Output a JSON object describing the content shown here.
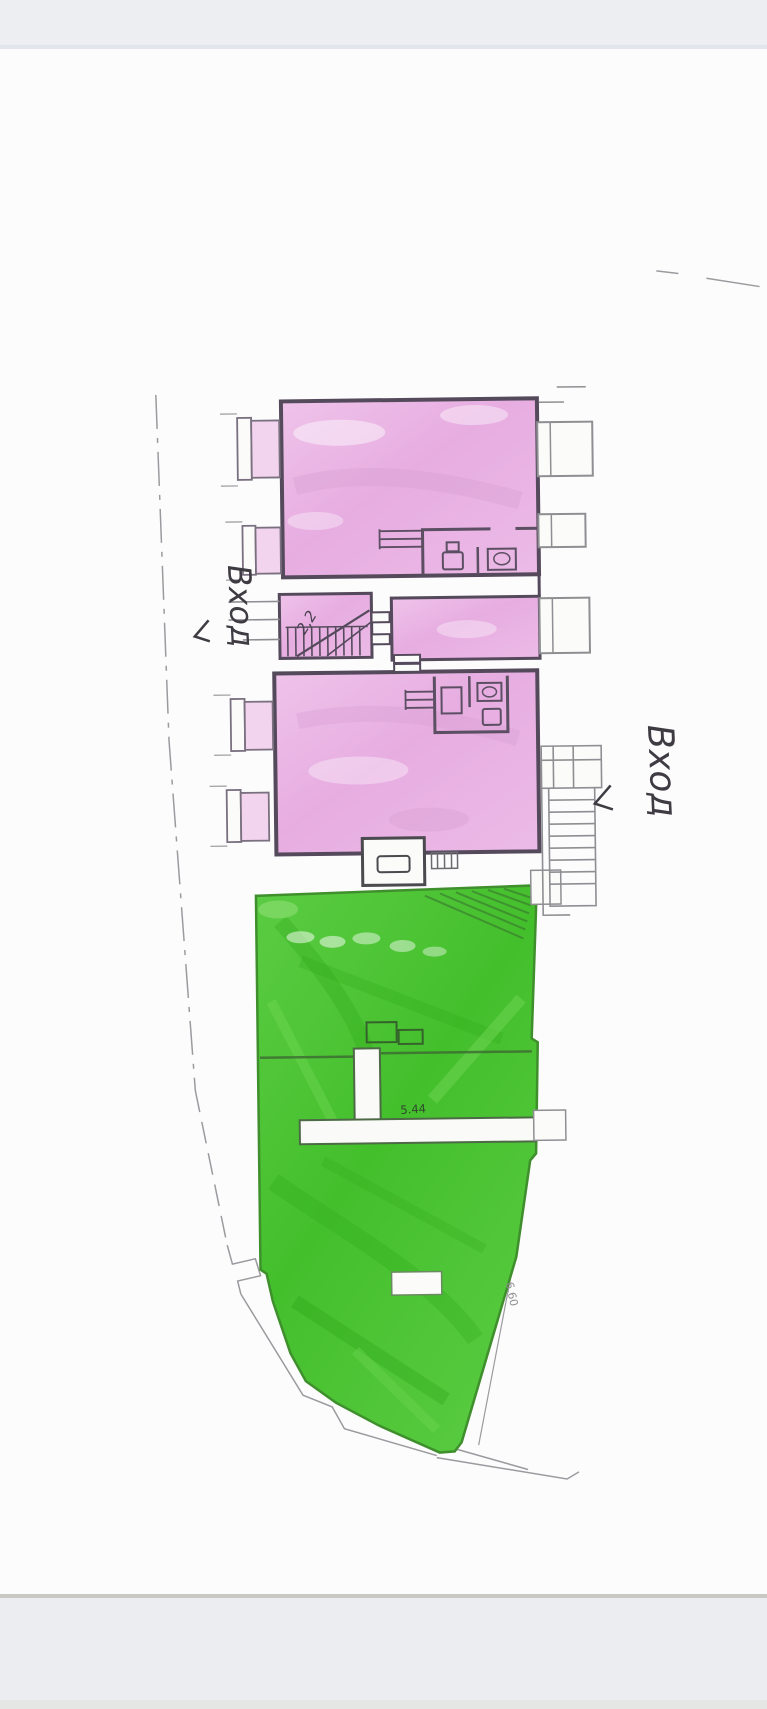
{
  "photo": {
    "top_band_color": "#eceef2",
    "bottom_band_color": "#ecedf0",
    "paper_color": "#fcfcfd"
  },
  "plan": {
    "labels": {
      "entrance_left": "Вход",
      "entrance_right": "Вход",
      "stair_dimension": "2,2",
      "room_dimension": "5.44",
      "boundary_dimension": "6.60"
    },
    "colors": {
      "pink_zone": "#e9b5e4",
      "green_zone": "#4cc636",
      "wall": "#554a5c",
      "boundary": "#97979b"
    }
  }
}
